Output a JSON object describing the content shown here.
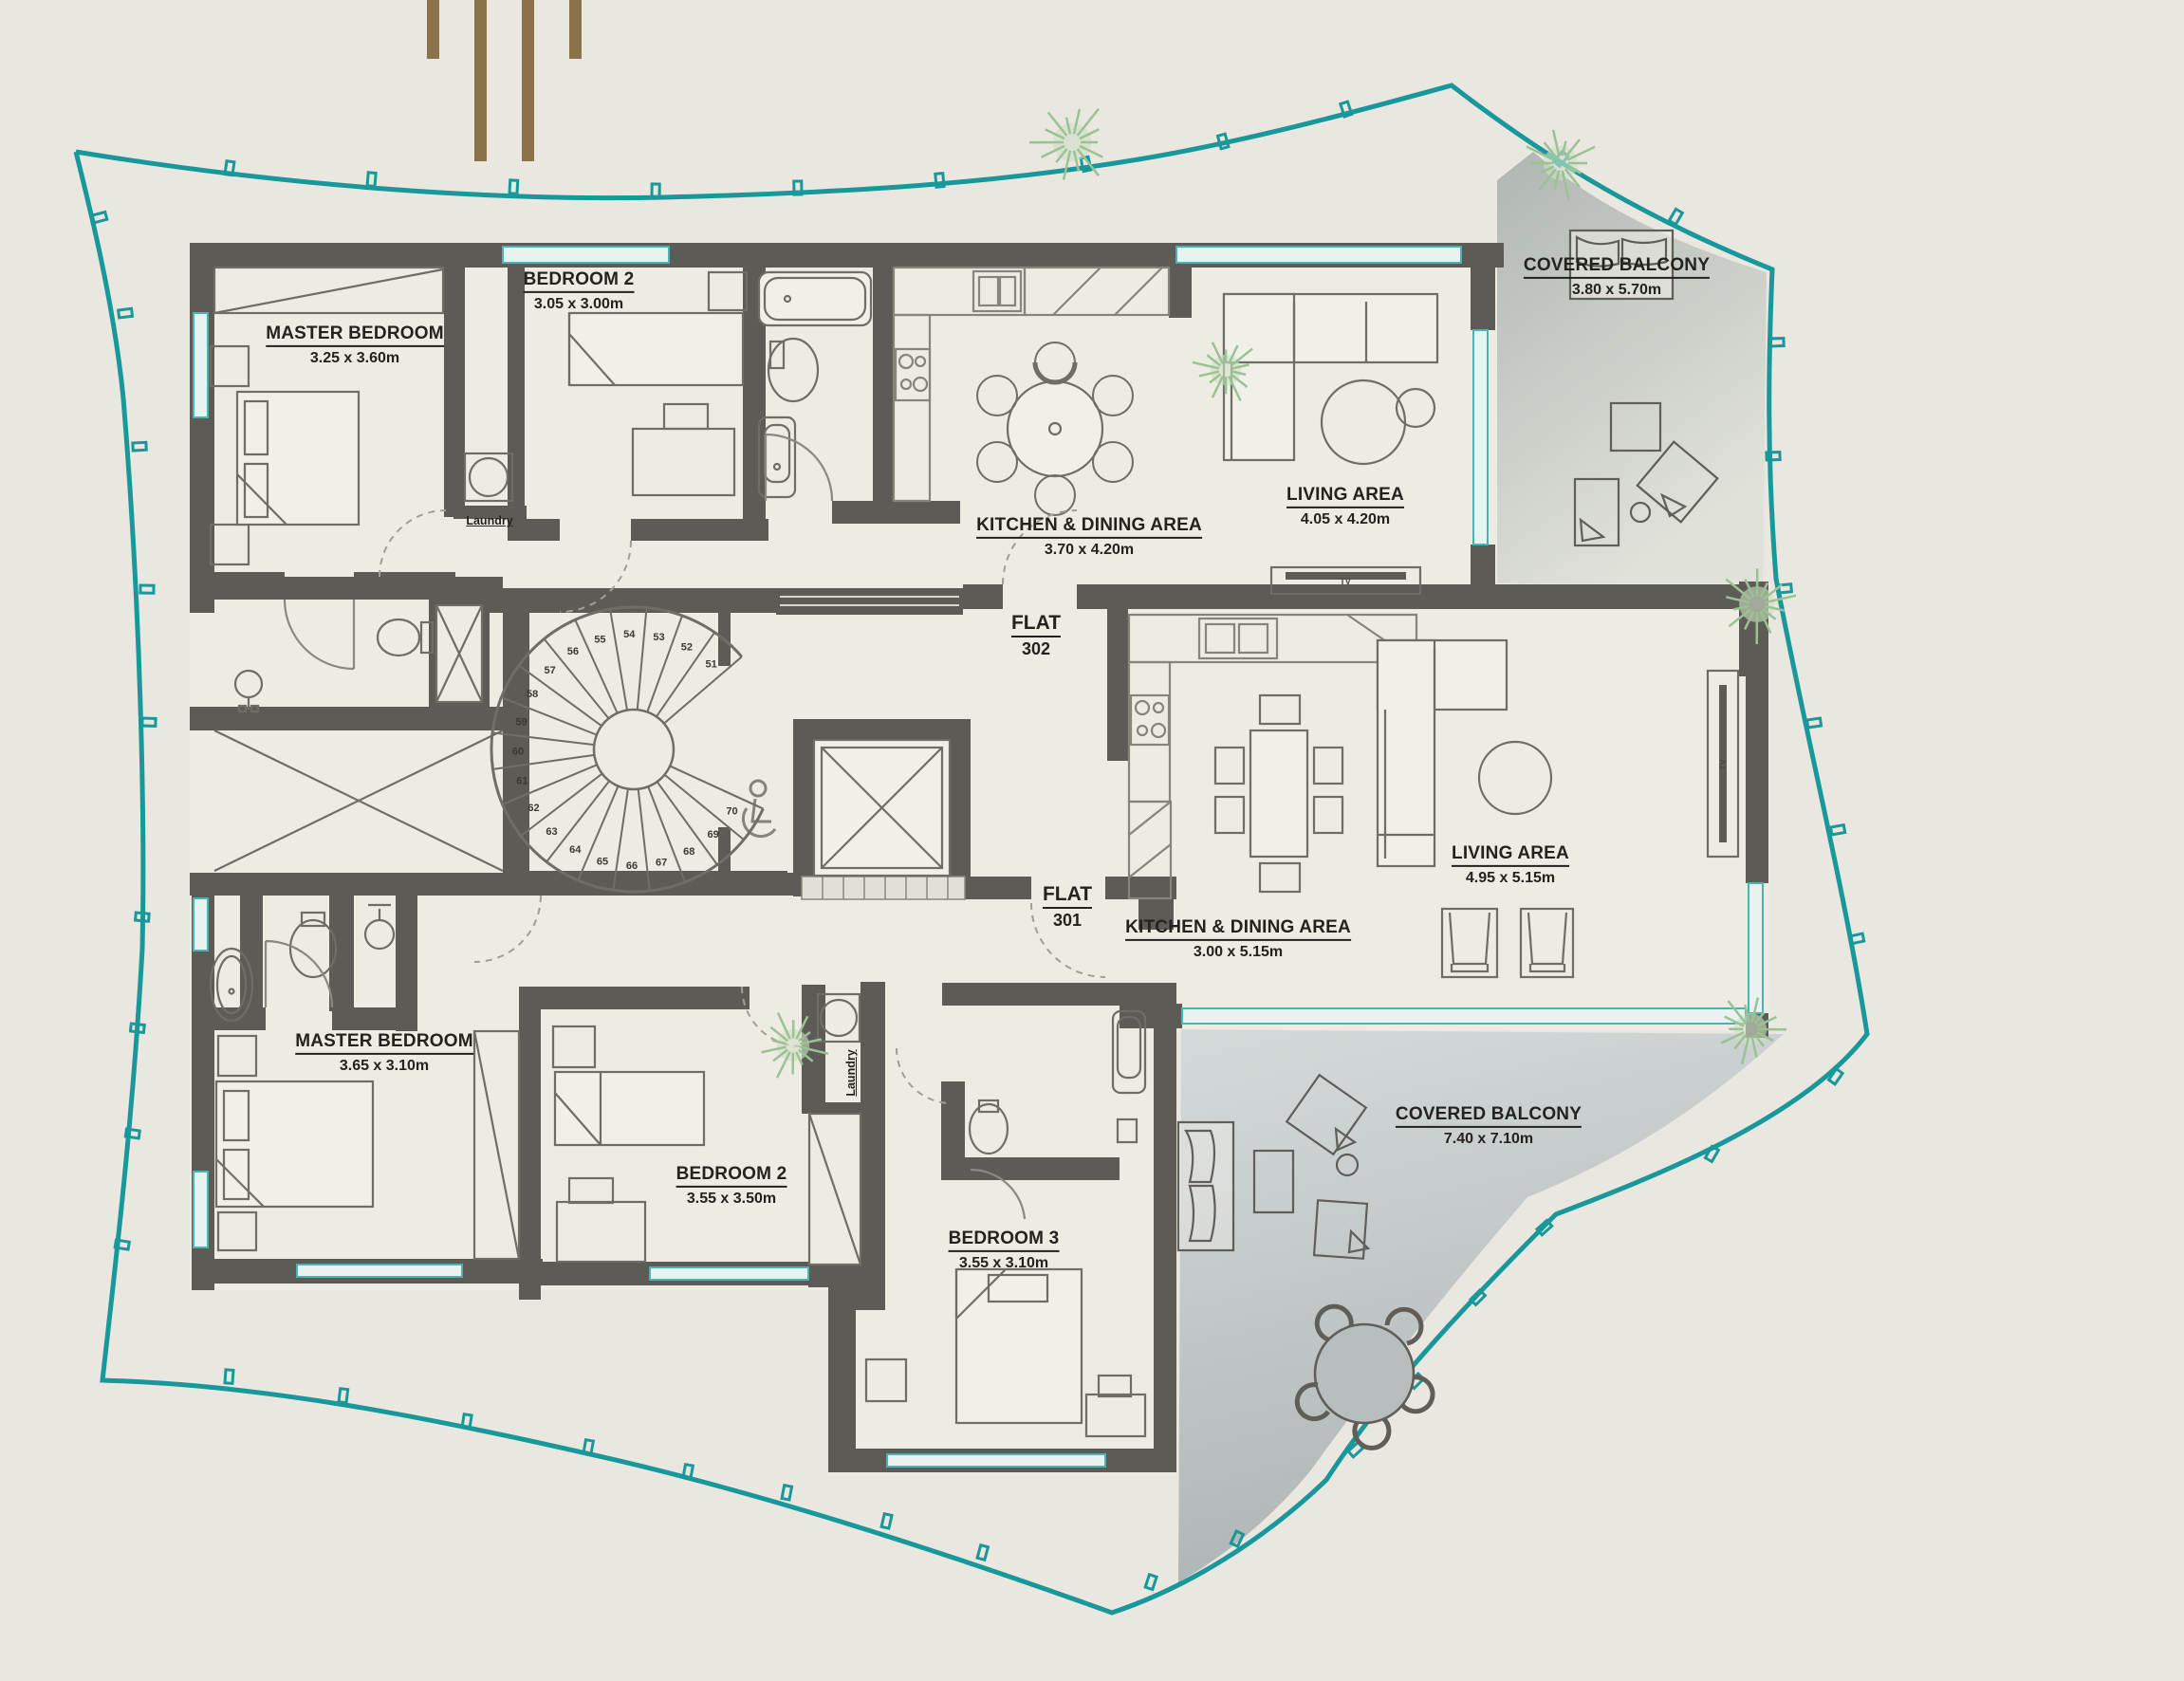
{
  "site": {
    "boundary_color": "#18989b",
    "logo_bars_color": "#8b7349",
    "wall_color": "#5c5b55",
    "background_color": "#e9e7df",
    "balcony_fill_light": "#d3d9d8",
    "balcony_fill_dark": "#b3b9b9"
  },
  "flats": {
    "f302": {
      "label": "FLAT",
      "number": "302"
    },
    "f301": {
      "label": "FLAT",
      "number": "301"
    }
  },
  "rooms": {
    "f302_master": {
      "title": "MASTER BEDROOM",
      "dims": "3.25 x 3.60m"
    },
    "f302_bedroom2": {
      "title": "BEDROOM 2",
      "dims": "3.05 x 3.00m"
    },
    "f302_kitchen": {
      "title": "KITCHEN & DINING AREA",
      "dims": "3.70 x 4.20m"
    },
    "f302_living": {
      "title": "LIVING AREA",
      "dims": "4.05 x 4.20m"
    },
    "f302_balcony": {
      "title": "COVERED BALCONY",
      "dims": "3.80 x 5.70m"
    },
    "f301_living": {
      "title": "LIVING AREA",
      "dims": "4.95 x 5.15m"
    },
    "f301_kitchen": {
      "title": "KITCHEN & DINING AREA",
      "dims": "3.00 x 5.15m"
    },
    "f301_balcony": {
      "title": "COVERED BALCONY",
      "dims": "7.40 x 7.10m"
    },
    "f301_master": {
      "title": "MASTER BEDROOM",
      "dims": "3.65 x 3.10m"
    },
    "f301_bedroom2": {
      "title": "BEDROOM 2",
      "dims": "3.55 x 3.50m"
    },
    "f301_bedroom3": {
      "title": "BEDROOM 3",
      "dims": "3.55 x 3.10m"
    }
  },
  "labels": {
    "laundry_302": "Laundry",
    "laundry_301": "Laundry",
    "tv_302": "TV",
    "tv_301": "TV"
  },
  "stairs": {
    "numbers": [
      51,
      52,
      53,
      54,
      55,
      56,
      57,
      58,
      59,
      60,
      61,
      62,
      63,
      64,
      65,
      66,
      67,
      68,
      69,
      70
    ]
  }
}
